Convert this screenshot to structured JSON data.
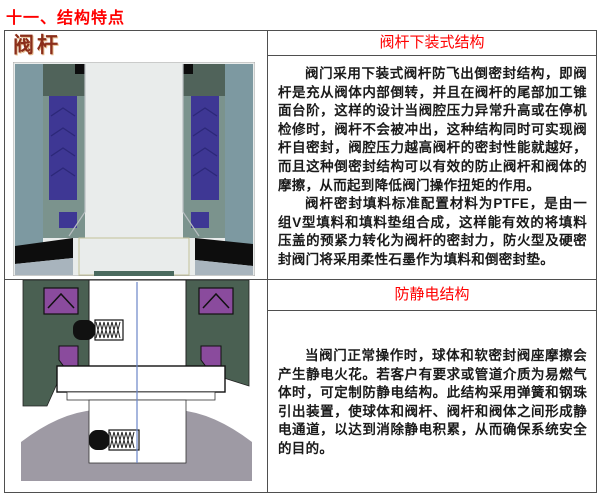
{
  "title": "十一、结构特点",
  "colors": {
    "accent_red": "#ff0000",
    "label_brown": "#8b2e1a",
    "text_color": "#1a1a1a",
    "d1_bg": "#e9eceb",
    "d1_outer": "#7d99a1",
    "d1_body": "#7b938d",
    "d1_top": "#50635a",
    "d1_purple": "#3e3794",
    "d1_chevron": "#2c2878",
    "d1_black": "#0d0d0d",
    "d1_bottom": "#a8b4bd",
    "d1_strip": "#4a6a5e",
    "d2_green": "#4a6052",
    "d2_purple": "#8a4b9d",
    "d2_grey": "#9e9aa4",
    "d2_line": "#6b86c8",
    "d2_black": "#111111"
  },
  "sections": [
    {
      "label": "阀杆",
      "header": "阀杆下装式结构",
      "diagram": "valve-stem-bottom-entry-cross-section",
      "paragraphs": [
        "阀门采用下装式阀杆防飞出倒密封结构，即阀杆是充从阀体内部倒转，并且在阀杆的尾部加工锥面台阶，这样的设计当阀腔压力异常升高或在停机检修时，阀杆不会被冲出，这种结构同时可实现阀杆自密封，阀腔压力越高阀杆的密封性能就越好，而且这种倒密封结构可以有效的防止阀杆和阀体的摩擦，从而起到降低阀门操作扭矩的作用。",
        "阀杆密封填料标准配置材料为PTFE，是由一组V型填料和填料垫组合成，这样能有效的将填料压盖的预紧力转化为阀杆的密封力，防火型及硬密封阀门将采用柔性石墨作为填料和倒密封垫。"
      ]
    },
    {
      "header": "防静电结构",
      "diagram": "anti-static-spring-ball-cross-section",
      "paragraphs": [
        "当阀门正常操作时，球体和软密封阀座摩擦会产生静电火花。若客户有要求或管道介质为易燃气体时，可定制防静电结构。此结构采用弹簧和钢珠引出装置，使球体和阀杆、阀杆和阀体之间形成静电通道，以达到消除静电积累，从而确保系统安全的目的。"
      ]
    }
  ]
}
